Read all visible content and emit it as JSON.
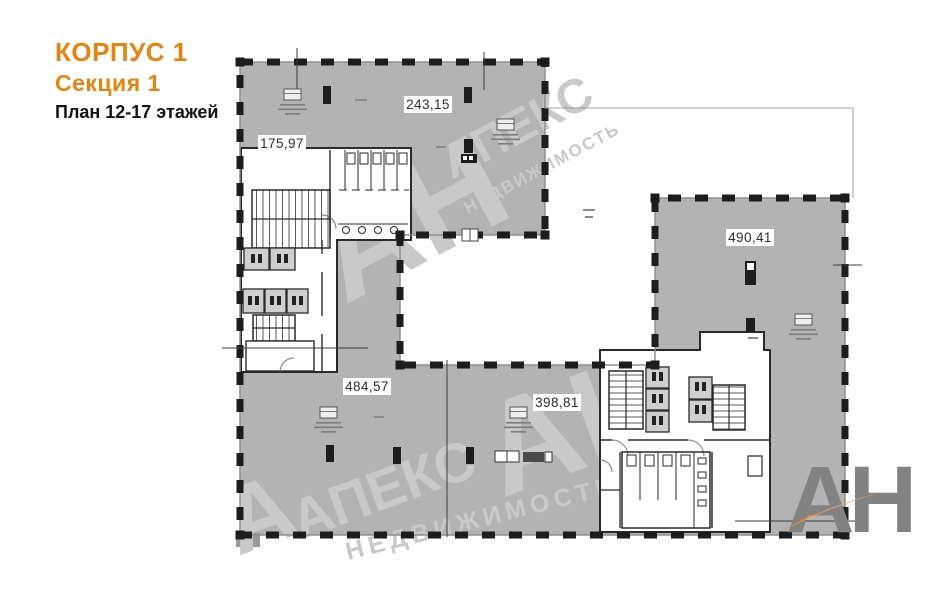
{
  "header": {
    "building": "КОРПУС 1",
    "section": "Секция 1",
    "plan": "План 12-17 этажей"
  },
  "rooms": [
    {
      "id": "room-1",
      "area": "175,97"
    },
    {
      "id": "room-2",
      "area": "243,15"
    },
    {
      "id": "room-3",
      "area": "490,41"
    },
    {
      "id": "room-4",
      "area": "484,57"
    },
    {
      "id": "room-5",
      "area": "398,81"
    }
  ],
  "watermark": {
    "monogram": "АН",
    "name": "АПЕКС",
    "tagline": "НЕДВИЖИМОСТЬ",
    "partial": "А"
  },
  "logo": {
    "monogram": "АН"
  },
  "colors": {
    "accent_orange": "#e8830d",
    "room_fill": "#b3b3b3",
    "wall_black": "#1d1d1d",
    "watermark_gray": "#c9c9c9",
    "logo_gray": "#828282",
    "logo_orange": "#efa05c"
  }
}
